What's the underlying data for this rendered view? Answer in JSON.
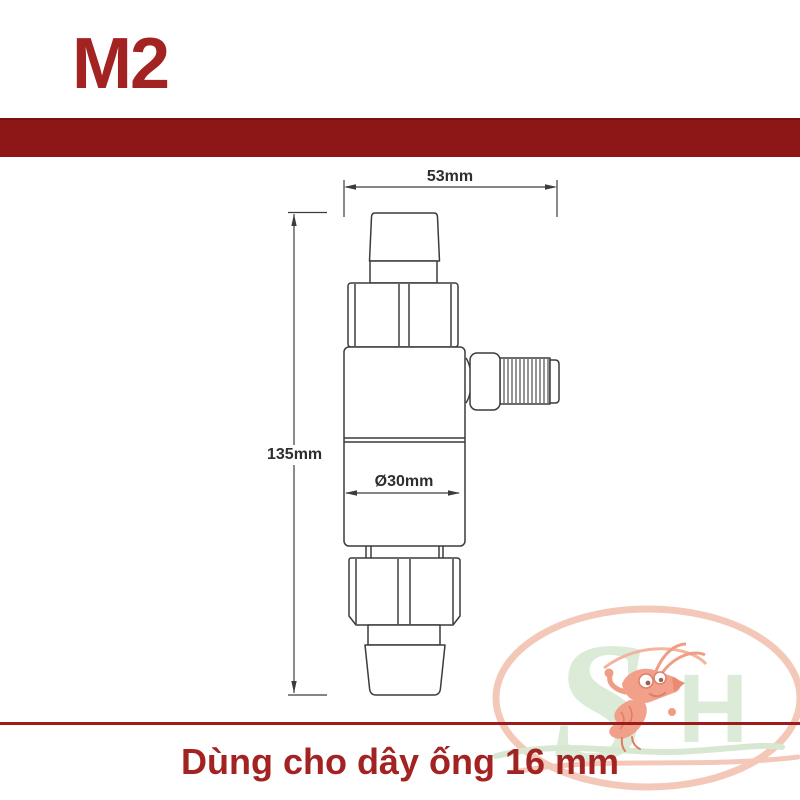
{
  "header": {
    "model_label": "M2"
  },
  "diagram": {
    "width_label": "53mm",
    "height_label": "135mm",
    "diameter_label": "Ø30mm"
  },
  "footer": {
    "caption": "Dùng cho dây ống 16 mm"
  },
  "watermark": {
    "letter_s": "S",
    "letter_h": "H"
  },
  "colors": {
    "brand_red_bar": "#8D1616",
    "brand_red_text": "#A32323",
    "bottom_rule_red": "#9A1C1C",
    "drawing_line": "#3C3C3C",
    "watermark_green": "#D9E8D4",
    "watermark_salmon": "#F3C3B2",
    "watermark_shrimp": "#F19178"
  }
}
